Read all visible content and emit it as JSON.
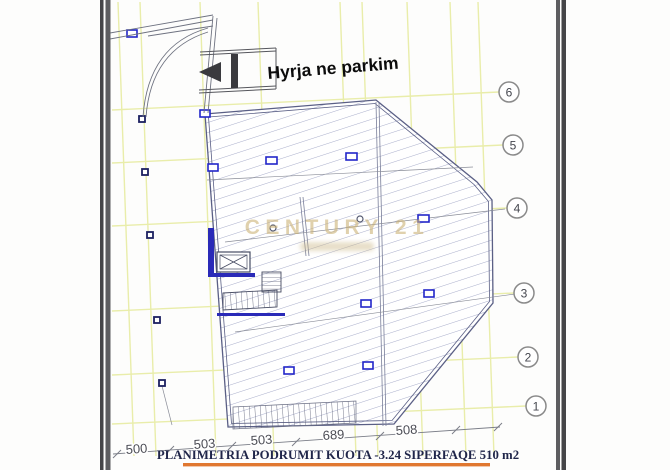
{
  "annotations": {
    "entrance_label": "Hyrja ne parkim"
  },
  "watermark": {
    "brand": "CENTURY 21"
  },
  "grid_bubbles": {
    "labels": [
      "6",
      "5",
      "4",
      "3",
      "2",
      "1"
    ]
  },
  "dimensions": {
    "values": [
      "500",
      "503",
      "503",
      "689",
      "508"
    ]
  },
  "title_block": {
    "text": "PLANIMETRIA  PODRUMIT KUOTA -3.24   SIPERFAQE  510 m2",
    "area_value": "510 m2",
    "level_value": "-3.24"
  },
  "colors": {
    "grid": "#e9edaa",
    "hatch": "#a9aecb",
    "wall": "#5a5f85",
    "blue_element": "#2a2ab8",
    "underline_orange": "#e0772f",
    "watermark_gold": "#cdb478"
  }
}
